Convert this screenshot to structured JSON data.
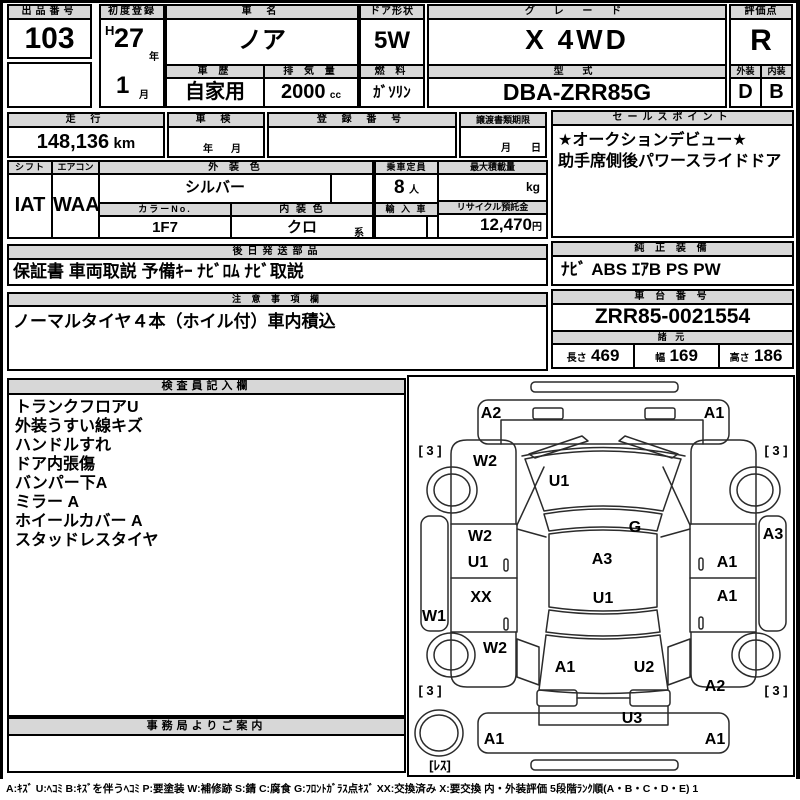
{
  "header": {
    "lot_label": "出品番号",
    "lot_value": "103",
    "first_reg_label": "初度登録",
    "first_reg_era": "H",
    "first_reg_year": "27",
    "first_reg_year_unit": "年",
    "first_reg_month": "1",
    "first_reg_month_unit": "月",
    "car_name_label": "車 名",
    "car_name": "ノア",
    "history_label": "車 歴",
    "history": "自家用",
    "displacement_label": "排 気 量",
    "displacement": "2000",
    "displacement_unit": "cc",
    "door_label": "ドア形状",
    "door": "5W",
    "fuel_label": "燃 料",
    "fuel": "ｶﾞｿﾘﾝ",
    "grade_label": "グ レ ー ド",
    "grade": "X 4WD",
    "model_label": "型 式",
    "model": "DBA-ZRR85G",
    "score_label": "評価点",
    "score": "R",
    "exterior_label": "外装",
    "exterior_grade": "D",
    "interior_label": "内装",
    "interior_grade": "B"
  },
  "registration": {
    "mileage_label": "走 行",
    "mileage": "148,136",
    "mileage_unit": "km",
    "inspection_label": "車 検",
    "inspection_year_unit": "年",
    "inspection_month_unit": "月",
    "reg_number_label": "登 録 番 号",
    "transfer_label": "譲渡書類期限",
    "transfer_month_unit": "月",
    "transfer_day_unit": "日"
  },
  "sales_point": {
    "label": "セールスポイント",
    "lines": [
      "★オークションデビュー★",
      "助手席側後パワースライドドア"
    ]
  },
  "spec": {
    "shift_label": "シフト",
    "shift": "IAT",
    "aircon_label": "エアコン",
    "aircon": "WAA",
    "ext_color_label": "外 装 色",
    "ext_color": "シルバー",
    "color_no_label": "カラーNo.",
    "color_no": "1F7",
    "int_color_label": "内 装 色",
    "int_color": "クロ",
    "int_color_suffix": "系",
    "capacity_label": "乗車定員",
    "capacity": "8",
    "capacity_unit": "人",
    "max_load_label": "最大積載量",
    "max_load_unit": "kg",
    "import_label": "輸 入 車",
    "recycle_label": "リサイクル預託金",
    "recycle_deposit": "12,470",
    "recycle_unit": "円"
  },
  "parts": {
    "label": "後日発送部品",
    "value": "保証書 車両取説 予備ｷｰ ﾅﾋﾞﾛﾑ ﾅﾋﾞ取説"
  },
  "equipment": {
    "label": "純 正 装 備",
    "value": "ﾅﾋﾞ ABS ｴｱB PS PW"
  },
  "notes": {
    "label": "注 意 事 項 欄",
    "value": "ノーマルタイヤ４本（ホイル付）車内積込"
  },
  "chassis": {
    "label": "車 台 番 号",
    "value": "ZRR85-0021554"
  },
  "dimensions": {
    "label": "諸 元",
    "length_label": "長さ",
    "length": "469",
    "width_label": "幅",
    "width": "169",
    "height_label": "高さ",
    "height": "186"
  },
  "inspector": {
    "label": "検査員記入欄",
    "lines": [
      "トランクフロアU",
      "外装うすい線キズ",
      "ハンドルすれ",
      "ドア内張傷",
      "バンパー下A",
      "ミラー A",
      "ホイールカバー A",
      "スタッドレスタイヤ"
    ]
  },
  "office": {
    "label": "事務局よりご案内"
  },
  "diagram": {
    "marks": [
      {
        "t": "A2",
        "x": 82,
        "y": 37
      },
      {
        "t": "A1",
        "x": 305,
        "y": 37
      },
      {
        "t": "[ 3 ]",
        "x": 21,
        "y": 74,
        "s": "small"
      },
      {
        "t": "[ 3 ]",
        "x": 367,
        "y": 74,
        "s": "small"
      },
      {
        "t": "W2",
        "x": 76,
        "y": 85
      },
      {
        "t": "U1",
        "x": 150,
        "y": 105
      },
      {
        "t": "G",
        "x": 226,
        "y": 151
      },
      {
        "t": "W2",
        "x": 71,
        "y": 160
      },
      {
        "t": "U1",
        "x": 69,
        "y": 186
      },
      {
        "t": "A3",
        "x": 193,
        "y": 183
      },
      {
        "t": "A3",
        "x": 364,
        "y": 158
      },
      {
        "t": "A1",
        "x": 318,
        "y": 186
      },
      {
        "t": "XX",
        "x": 72,
        "y": 221
      },
      {
        "t": "U1",
        "x": 194,
        "y": 222
      },
      {
        "t": "A1",
        "x": 318,
        "y": 220
      },
      {
        "t": "W1",
        "x": 25,
        "y": 240
      },
      {
        "t": "W2",
        "x": 86,
        "y": 272
      },
      {
        "t": "A1",
        "x": 156,
        "y": 291
      },
      {
        "t": "U2",
        "x": 235,
        "y": 291
      },
      {
        "t": "A2",
        "x": 306,
        "y": 310
      },
      {
        "t": "[ 3 ]",
        "x": 21,
        "y": 314,
        "s": "small"
      },
      {
        "t": "[ 3 ]",
        "x": 367,
        "y": 314,
        "s": "small"
      },
      {
        "t": "U3",
        "x": 223,
        "y": 342
      },
      {
        "t": "A1",
        "x": 85,
        "y": 363
      },
      {
        "t": "A1",
        "x": 306,
        "y": 363
      },
      {
        "t": "[ﾚｽ]",
        "x": 31,
        "y": 389,
        "s": "small"
      }
    ]
  },
  "legend": {
    "text": "A:ｷｽﾞ U:ﾍｺﾐ B:ｷｽﾞを伴うﾍｺﾐ P:要塗装 W:補修跡 S:錆 C:腐食 G:ﾌﾛﾝﾄｶﾞﾗｽ点ｷｽﾞ XX:交換済み X:要交換  内・外装評価 5段階ﾗﾝｸ順(A・B・C・D・E) 1"
  }
}
